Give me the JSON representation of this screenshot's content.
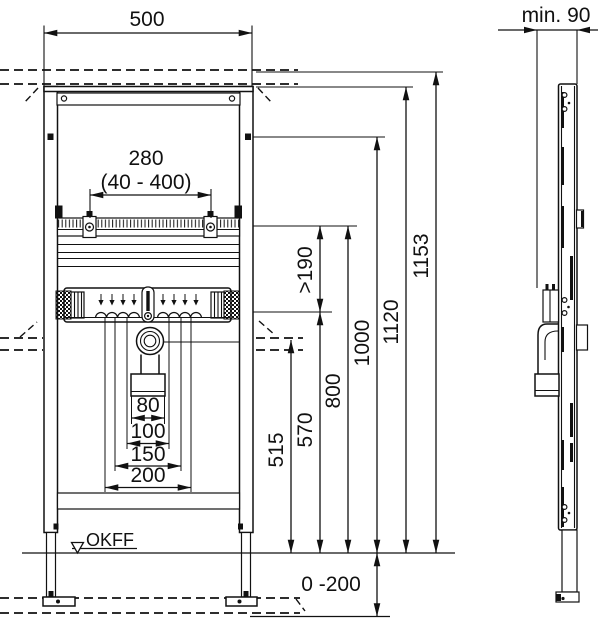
{
  "dimensions": {
    "width": "500",
    "depth": "min. 90",
    "fixing_spacing": "280",
    "fixing_spacing_range": "(40 - 400)",
    "clearance_min": ">190",
    "height_total": "1153",
    "height_frame": "1120",
    "height_1000": "1000",
    "height_800": "800",
    "height_570": "570",
    "height_515": "515",
    "drain_outlet_width": "80",
    "spacing_100": "100",
    "spacing_150": "150",
    "spacing_200": "200",
    "floor_buildup_range": "0 -200"
  },
  "labels": {
    "finished_floor": "OKFF"
  },
  "colors": {
    "line": "#111111",
    "background": "#ffffff"
  }
}
